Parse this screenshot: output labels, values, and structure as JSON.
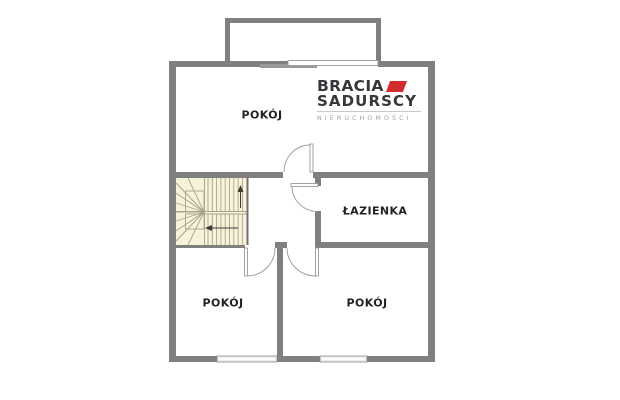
{
  "plan": {
    "rooms": [
      {
        "id": "room-top",
        "label": "POKÓJ"
      },
      {
        "id": "bathroom",
        "label": "ŁAZIENKA"
      },
      {
        "id": "room-bottom-left",
        "label": "POKÓJ"
      },
      {
        "id": "room-bottom-right",
        "label": "POKÓJ"
      }
    ],
    "features": [
      "staircase",
      "balcony",
      "sliding-door",
      "window",
      "window"
    ],
    "colors": {
      "wall": "#7f7f7f",
      "stair_fill": "#f7f3da",
      "stair_line": "#a8a289",
      "door_line": "#9a9a9a",
      "window_fill": "#ededed"
    }
  },
  "logo": {
    "brand_line1": "BRACIA",
    "brand_line2": "SADURSCY",
    "tagline": "NIERUCHOMOŚCI",
    "colors": {
      "text": "#37373b",
      "accent": "#d22c2c",
      "tagline": "#a3a3a3"
    }
  }
}
